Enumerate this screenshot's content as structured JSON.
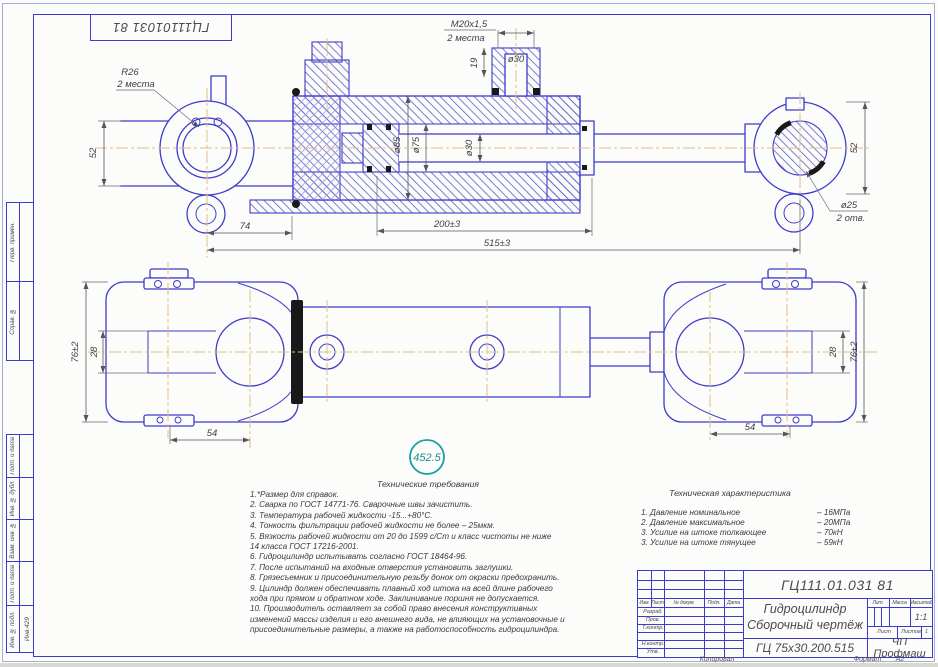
{
  "colors": {
    "line_blue": "#3c3ccb",
    "dim_gray": "#45454c",
    "centerline_tan": "#e0bf83",
    "balloon_teal": "#17a2a2",
    "seal_black": "#191919"
  },
  "corner_stamp": "ГЦ11101031 81",
  "dims": {
    "r26": "R26",
    "r26_note": "2 места",
    "m20": "M20x1,5",
    "m20_note": "2 места",
    "d30_port": "ø30",
    "dim19": "19",
    "d85": "ø85",
    "d75": "ø75",
    "d30_rod": "ø30",
    "dim52_left": "52",
    "dim52_right": "52",
    "d25": "ø25",
    "d25_note": "2 отв.",
    "dim74": "74",
    "dim200": "200±3",
    "dim515": "515±3",
    "dim76_left": "76±2",
    "dim28_left": "28",
    "dim54_left": "54",
    "dim76_right": "76±2",
    "dim28_right": "28",
    "dim54_right": "54"
  },
  "balloon": "452.5",
  "tech_req": {
    "title": "Технические требования",
    "lines": [
      "1.*Размер для справок.",
      "2. Сварка по ГОСТ 14771-76. Сварочные швы зачистить.",
      "3. Температура рабочей жидкости   -15...+80°С.",
      "4. Тонкость фильтрации рабочей жидкости не более  – 25мкм.",
      "5. Вязкость рабочей жидкости от 20 до 1599 с/Ст и класс чистоты не ниже",
      "14 класса ГОСТ 17216-2001.",
      "6. Гидроцилиндр испытывать согласно ГОСТ 18464-96.",
      "7. После испытаний на входные отверстия установить заглушки.",
      "8. Грязесъемник и присоединительную резьбу донок от окраски предохранить.",
      "9. Цилиндр должен обеспечивать плавный ход штока на всей длине рабочего",
      "хода при прямом и обратном ходе. Заклинивание поршня не допускается.",
      "10. Производитель оставляет за собой право внесения конструктивных",
      "изменений массы изделия и его внешнего вида, не влияющих на установочные и",
      "присоединительные размеры, а также на работоспособность гидроцилиндра."
    ]
  },
  "tech_char": {
    "title": "Техническая характеристика",
    "items": [
      {
        "label": "1. Давление номинальное",
        "value": "– 16МПа"
      },
      {
        "label": "2. Давление максимальное",
        "value": "– 20МПа"
      },
      {
        "label": "3. Усилие на штоке толкающее",
        "value": "– 70кН"
      },
      {
        "label": "3. Усилие на штоке тянущее",
        "value": "– 59кН"
      }
    ]
  },
  "title_block": {
    "doc_number": "ГЦ111.01.031 81",
    "product_name_line1": "Гидроцилиндр",
    "product_name_line2": "Сборочный чертёж",
    "designation": "ГЦ 75х30.200.515",
    "company": "ЧП Профмаш",
    "col_izm": "Изм.",
    "col_list": "Лист",
    "col_doc": "№ докум.",
    "col_podp": "Подп.",
    "col_data": "Дата",
    "row_razrab": "Разраб.",
    "row_prov": "Пров.",
    "row_tkontr": "Т.контр.",
    "row_nkontr": "Н.контр.",
    "row_utv": "Утв.",
    "lit_label": "Лит.",
    "mass_label": "Масса",
    "scale_label": "Масштаб",
    "scale_value": "1:1",
    "sheet_label": "Лист",
    "sheets_label": "Листов",
    "sheets_value": "1"
  },
  "margin_stamps": {
    "items": [
      "Перв. примен.",
      "Справ. №",
      "Подп. и дата",
      "Инв. № дубл.",
      "Взам. инв. №",
      "Подп. и дата",
      "Инв. № подл."
    ],
    "inv_number": "Инв.429"
  },
  "footer": {
    "copied": "Копировал",
    "format_label": "Формат",
    "format_value": "А2"
  }
}
